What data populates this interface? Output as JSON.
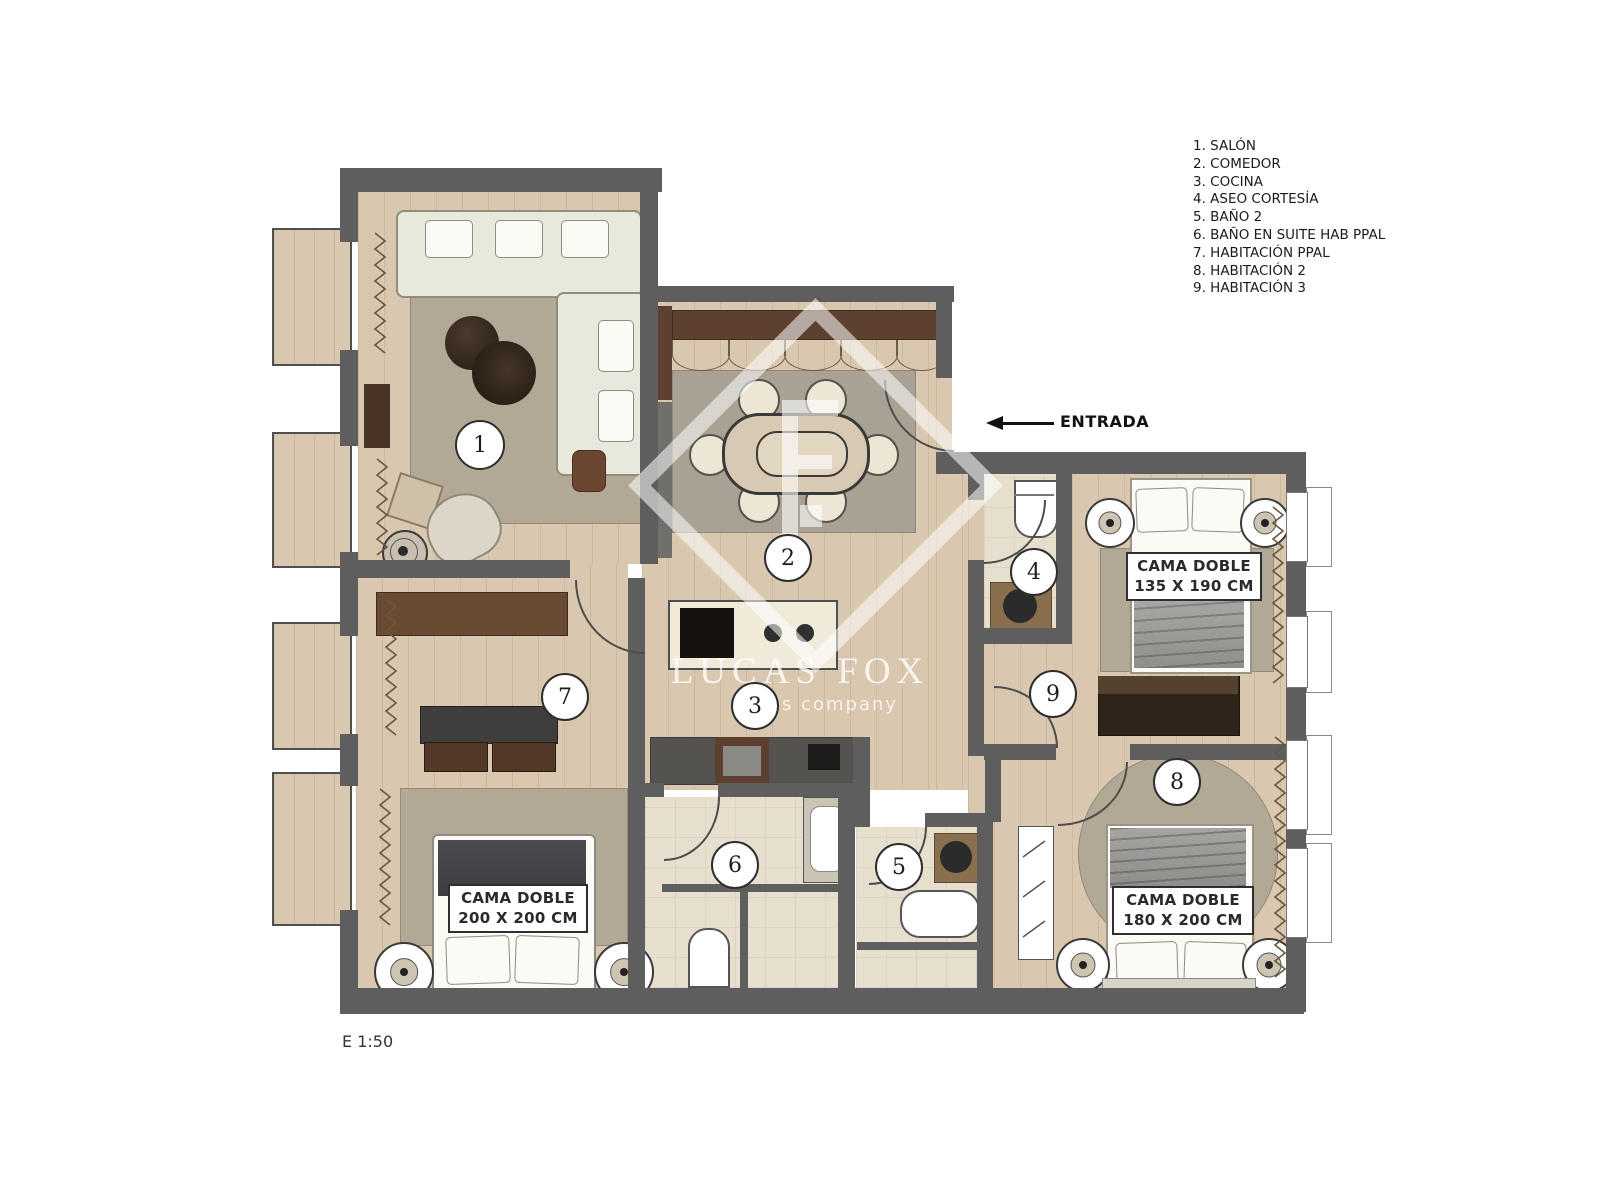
{
  "legend": {
    "items": [
      "1. SALÓN",
      "2. COMEDOR",
      "3. COCINA",
      "4. ASEO CORTESÍA",
      "5. BAÑO 2",
      "6. BAÑO EN SUITE HAB PPAL",
      "7. HABITACIÓN PPAL",
      "8. HABITACIÓN 2",
      "9. HABITACIÓN 3"
    ]
  },
  "markers": {
    "salon": "1",
    "comedor": "2",
    "cocina": "3",
    "aseo": "4",
    "bano2": "5",
    "bano_suite": "6",
    "hab_ppal": "7",
    "hab2": "8",
    "hab3": "9"
  },
  "labels": {
    "entrance": "ENTRADA",
    "scale": "E 1:50"
  },
  "watermark": {
    "title": "LUCAS FOX",
    "subtitle": "lls company"
  },
  "bed_labels": {
    "hab3": {
      "line1": "CAMA DOBLE",
      "line2": "135 X 190 CM"
    },
    "hab_ppal": {
      "line1": "CAMA DOBLE",
      "line2": "200 X 200 CM"
    },
    "hab2": {
      "line1": "CAMA DOBLE",
      "line2": "180 X 200 CM"
    }
  },
  "colors": {
    "wall": "#5e5e5e",
    "wood": "#d9c8af",
    "tile": "#e7dfce",
    "rug": "#b2a896",
    "brown": "#5d4030"
  }
}
